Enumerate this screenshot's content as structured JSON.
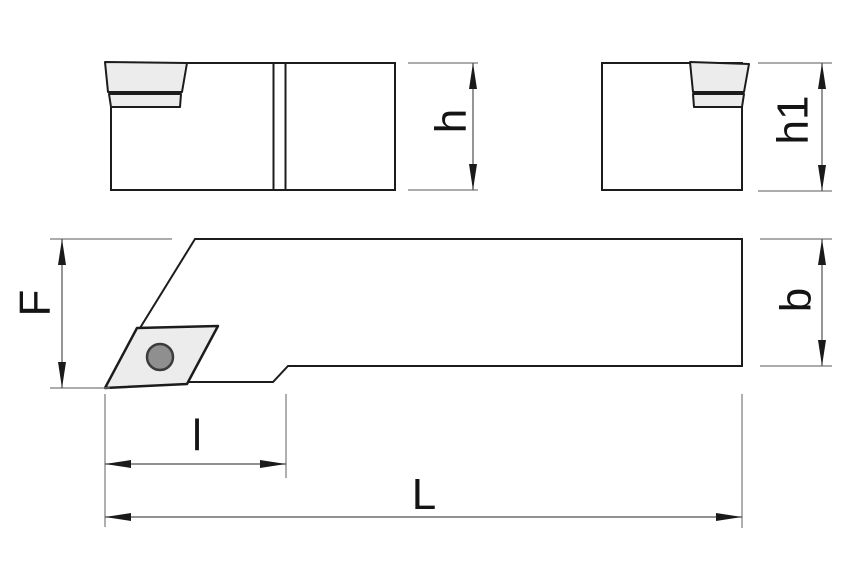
{
  "dimensions": {
    "h": "h",
    "h1": "h1",
    "F": "F",
    "b": "b",
    "l": "l",
    "L": "L"
  },
  "colors": {
    "background": "#ffffff",
    "outline": "#1c1c1c",
    "dimension_lines": "#4f4f4f",
    "extension_lines": "#7a7a7a",
    "label_text": "#141414",
    "insert_fill": "#ececec",
    "hole_fill": "#8f8f8f"
  }
}
